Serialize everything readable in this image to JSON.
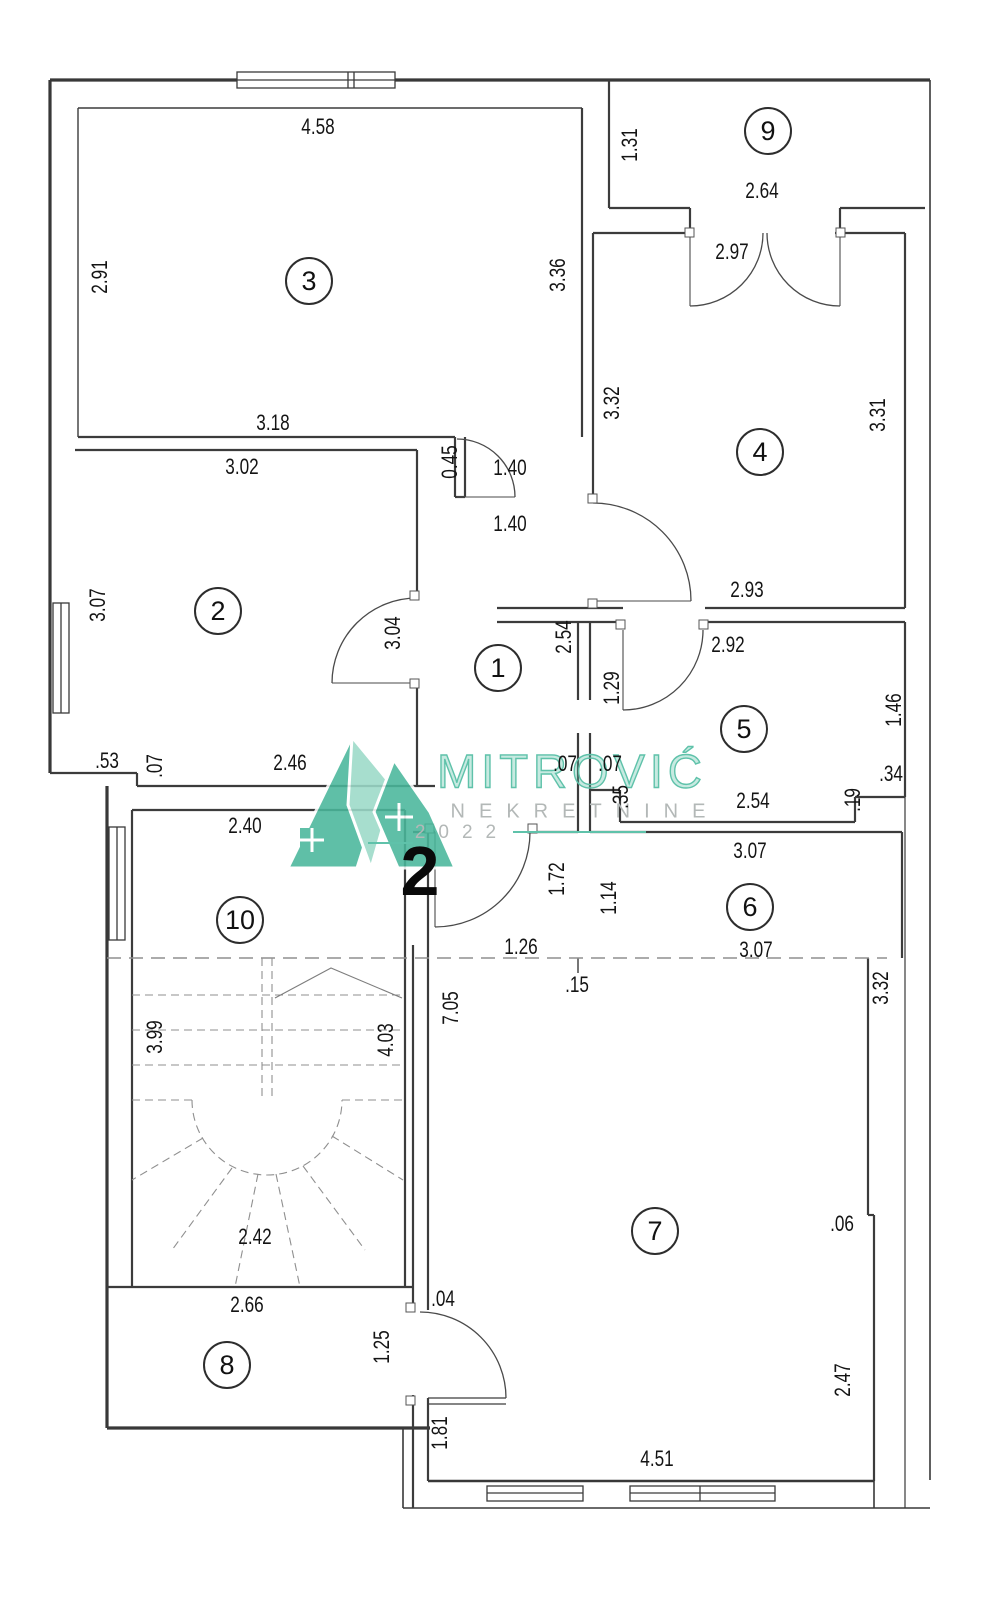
{
  "watermark": {
    "brand": "MITROVIĆ",
    "subtitle": "NEKRETNINE",
    "year": "2022"
  },
  "apartment_number": "2",
  "rooms": [
    "1",
    "2",
    "3",
    "4",
    "5",
    "6",
    "7",
    "8",
    "9",
    "10"
  ],
  "dimensions": [
    "4.58",
    "2.91",
    "3.18",
    "3.02",
    "3.07",
    ".53",
    ".07",
    "2.46",
    "2.40",
    "1.31",
    "2.64",
    "2.97",
    "3.36",
    "3.32",
    "3.31",
    "0.45",
    "1.40",
    "1.40",
    "3.04",
    "2.54",
    "1.29",
    "2.93",
    "2.92",
    "1.46",
    ".34",
    ".19",
    "2.54",
    ".07",
    ".07",
    ".35",
    "1.72",
    "1.14",
    "3.07",
    "3.07",
    "1.26",
    ".15",
    "3.32",
    "7.05",
    "3.99",
    "4.03",
    "2.42",
    ".06",
    "2.47",
    "2.66",
    "1.25",
    ".04",
    "1.81",
    "4.51"
  ]
}
